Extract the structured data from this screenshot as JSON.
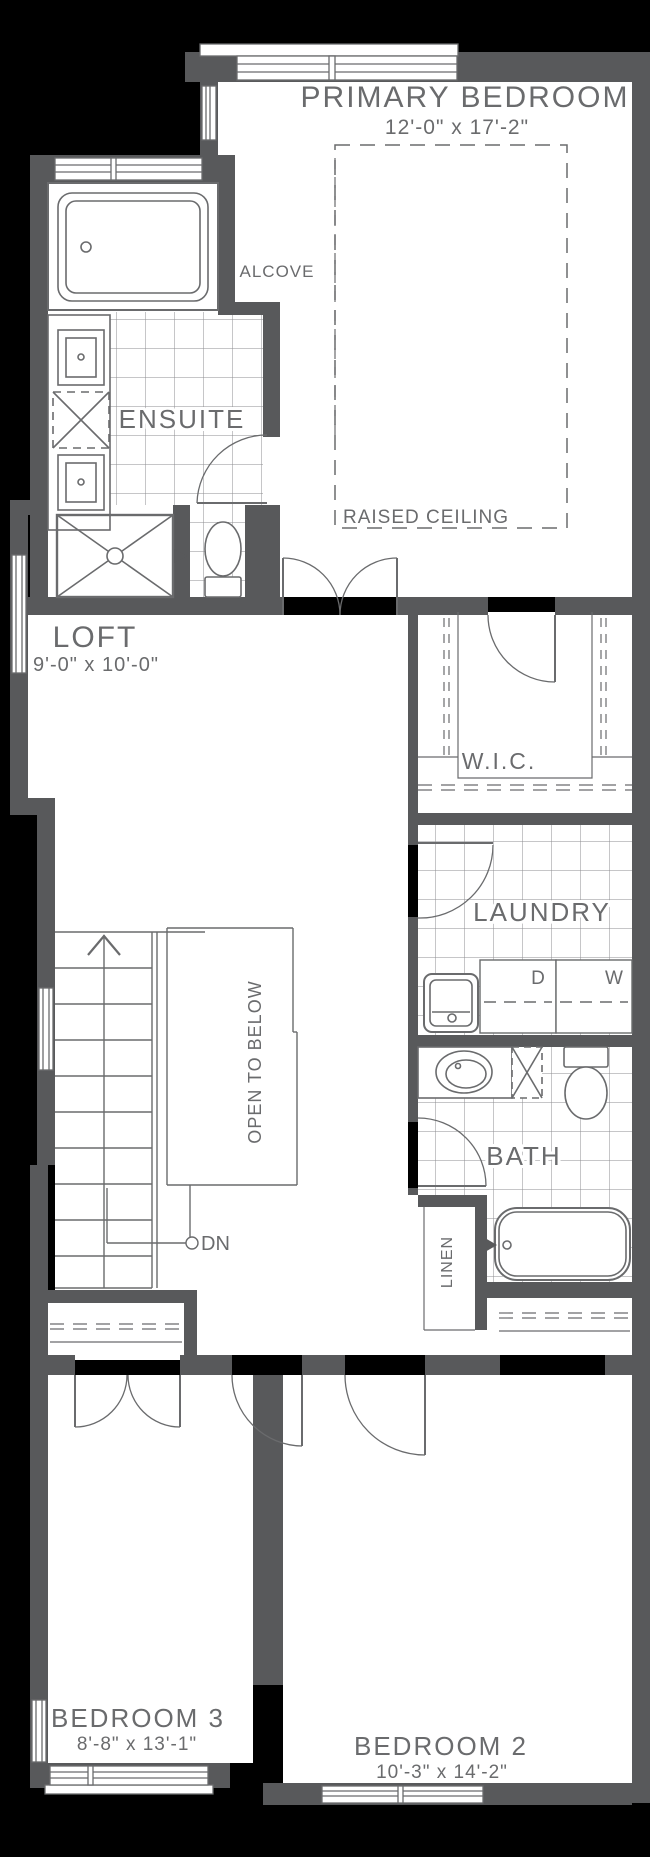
{
  "title": "Second floor plan",
  "rooms": {
    "primary_bedroom": {
      "label": "PRIMARY BEDROOM",
      "dims": "12'-0\" x 17'-2\""
    },
    "alcove": {
      "label": "ALCOVE"
    },
    "ensuite": {
      "label": "ENSUITE"
    },
    "loft": {
      "label": "LOFT",
      "dims": "9'-0\" x 10'-0\""
    },
    "wic": {
      "label": "W.I.C."
    },
    "laundry": {
      "label": "LAUNDRY"
    },
    "bath": {
      "label": "BATH"
    },
    "linen": {
      "label": "LINEN"
    },
    "bedroom3": {
      "label": "BEDROOM 3",
      "dims": "8'-8\" x 13'-1\""
    },
    "bedroom2": {
      "label": "BEDROOM 2",
      "dims": "10'-3\" x 14'-2\""
    }
  },
  "annotations": {
    "raised_ceiling": "RAISED CEILING",
    "open_to_below": "OPEN TO BELOW",
    "down": "DN",
    "dryer": "D",
    "washer": "W"
  },
  "colors": {
    "background": "#000000",
    "wall": "#58595b",
    "line": "#6a6b6d",
    "tile_line": "#8d8e90",
    "floor": "#ffffff"
  }
}
